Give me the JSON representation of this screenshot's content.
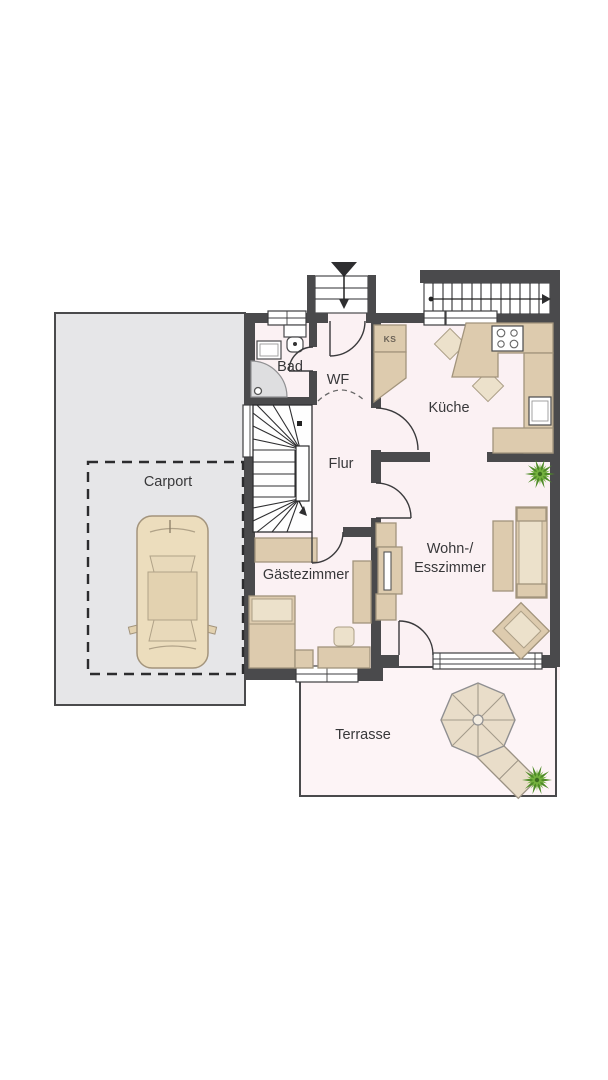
{
  "floorplan": {
    "rooms": {
      "carport": {
        "label": "Carport"
      },
      "bad": {
        "label": "Bad"
      },
      "wf": {
        "label": "WF"
      },
      "flur": {
        "label": "Flur"
      },
      "kueche": {
        "label": "Küche"
      },
      "gaestezimmer": {
        "label": "Gästezimmer"
      },
      "wohn_esszimmer": {
        "label_line1": "Wohn-/",
        "label_line2": "Esszimmer"
      },
      "terrasse": {
        "label": "Terrasse"
      }
    },
    "annotations": {
      "fridge": "KS"
    },
    "colors": {
      "wall": "#4a4a4c",
      "floor": "#fbf1f3",
      "terrace": "#fdf4f6",
      "carport_ground": "#e6e6e8",
      "furniture": "#ddcbae",
      "furniture_light": "#ece1cb",
      "plant_dark": "#4f8c28",
      "plant_light": "#74b13e",
      "background": "#ffffff"
    }
  }
}
